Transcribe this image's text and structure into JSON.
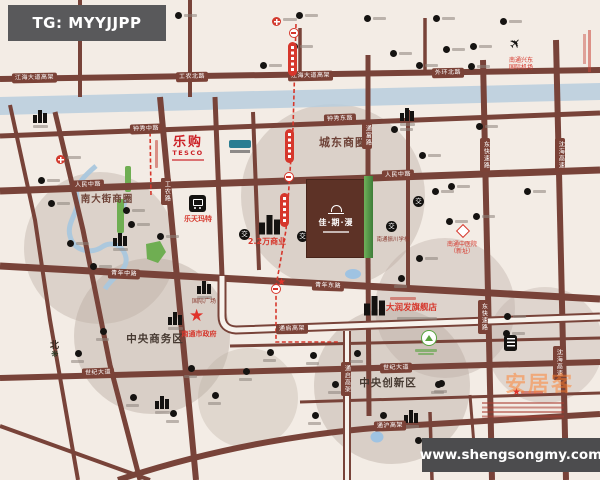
{
  "badges": {
    "tg": "TG: MYYJJPP",
    "website": "www.shengsongmy.com",
    "watermark": "安居客"
  },
  "circles": {
    "east": "城东商圈",
    "south_street": "南大街商圈",
    "cbd": "中央商务区",
    "innovation": "中央创新区"
  },
  "roads": {
    "jianghai_w": "江海大道高架",
    "gongnong_n": "工农北路",
    "jianghai_e": "江海大道高架",
    "waihuan_n": "外环北路",
    "zhongxiu_m": "钟秀中路",
    "zhongxiu_e": "钟秀东路",
    "renmin_w": "人民中路",
    "renmin_e": "人民中路",
    "qingnian_m": "青年中路",
    "qingnian_e": "青年东路",
    "shiji_w": "世纪大道",
    "shiji_e": "世纪大道",
    "tongqi": "通启高架",
    "tongqi_v": "通启高架",
    "tonghu": "通沪高架",
    "gongnong": "工农路",
    "tongfu": "通富路",
    "dongkuaisu_1": "东快速路",
    "dongkuaisu_2": "东快速路",
    "shenhai_1": "沈海高速",
    "shenhai_2": "沈海高速"
  },
  "property": {
    "name": "佳·期·漫"
  },
  "landmarks": {
    "tesco_cn": "乐购",
    "tesco_en": "TESCO",
    "lotte": "乐天玛特",
    "commercial": "2.2万商业",
    "rtmart": "大润发旗舰店",
    "government": "南通市政府",
    "school": "南通振川学校",
    "hospital_line1": "南通中医院",
    "hospital_line2": "（新址）",
    "airport_line1": "南通兴东",
    "airport_line2": "国际机场",
    "intl_plaza": "国际广场",
    "compass": "北"
  },
  "icons": {
    "jiao": "交",
    "star": "★",
    "plane": "✈",
    "tree": "❋"
  },
  "map_icons": [
    [
      14,
      13,
      "d"
    ],
    [
      57,
      12,
      "d"
    ],
    [
      175,
      12,
      "d"
    ],
    [
      296,
      12,
      "d"
    ],
    [
      364,
      15,
      "d"
    ],
    [
      433,
      15,
      "d"
    ],
    [
      500,
      18,
      "d"
    ],
    [
      95,
      14,
      "f"
    ],
    [
      272,
      17,
      "f"
    ],
    [
      56,
      155,
      "f"
    ],
    [
      260,
      62,
      "d"
    ],
    [
      291,
      43,
      "d"
    ],
    [
      390,
      50,
      "d"
    ],
    [
      416,
      62,
      "d"
    ],
    [
      443,
      46,
      "d"
    ],
    [
      470,
      43,
      "d"
    ],
    [
      468,
      63,
      "d"
    ],
    [
      33,
      110,
      "B"
    ],
    [
      400,
      108,
      "B"
    ],
    [
      113,
      233,
      "B"
    ],
    [
      155,
      396,
      "B"
    ],
    [
      404,
      410,
      "B"
    ],
    [
      168,
      312,
      "B"
    ],
    [
      197,
      281,
      "B"
    ],
    [
      38,
      177,
      "d"
    ],
    [
      48,
      200,
      "d"
    ],
    [
      123,
      207,
      "d"
    ],
    [
      128,
      221,
      "d"
    ],
    [
      157,
      233,
      "d"
    ],
    [
      67,
      240,
      "d"
    ],
    [
      90,
      263,
      "d"
    ],
    [
      100,
      328,
      "b"
    ],
    [
      75,
      350,
      "b"
    ],
    [
      130,
      394,
      "b"
    ],
    [
      170,
      410,
      "b"
    ],
    [
      212,
      392,
      "b"
    ],
    [
      188,
      365,
      "b"
    ],
    [
      243,
      368,
      "b"
    ],
    [
      267,
      349,
      "b"
    ],
    [
      310,
      352,
      "b"
    ],
    [
      354,
      350,
      "b"
    ],
    [
      391,
      126,
      "d"
    ],
    [
      432,
      188,
      "d"
    ],
    [
      448,
      183,
      "d"
    ],
    [
      473,
      213,
      "d"
    ],
    [
      446,
      218,
      "d"
    ],
    [
      416,
      255,
      "d"
    ],
    [
      476,
      123,
      "d"
    ],
    [
      419,
      152,
      "d"
    ],
    [
      524,
      188,
      "d"
    ],
    [
      398,
      275,
      "b"
    ],
    [
      504,
      313,
      "d"
    ],
    [
      503,
      330,
      "d"
    ],
    [
      438,
      380,
      "b"
    ],
    [
      332,
      381,
      "b"
    ],
    [
      435,
      381,
      "b"
    ],
    [
      312,
      412,
      "b"
    ],
    [
      380,
      412,
      "b"
    ],
    [
      415,
      437,
      "d"
    ],
    [
      239,
      229,
      "j"
    ],
    [
      297,
      231,
      "j"
    ],
    [
      413,
      196,
      "j"
    ],
    [
      504,
      335,
      "v"
    ],
    [
      421,
      330,
      "p"
    ],
    [
      277,
      278,
      "s"
    ],
    [
      512,
      388,
      "s"
    ]
  ]
}
